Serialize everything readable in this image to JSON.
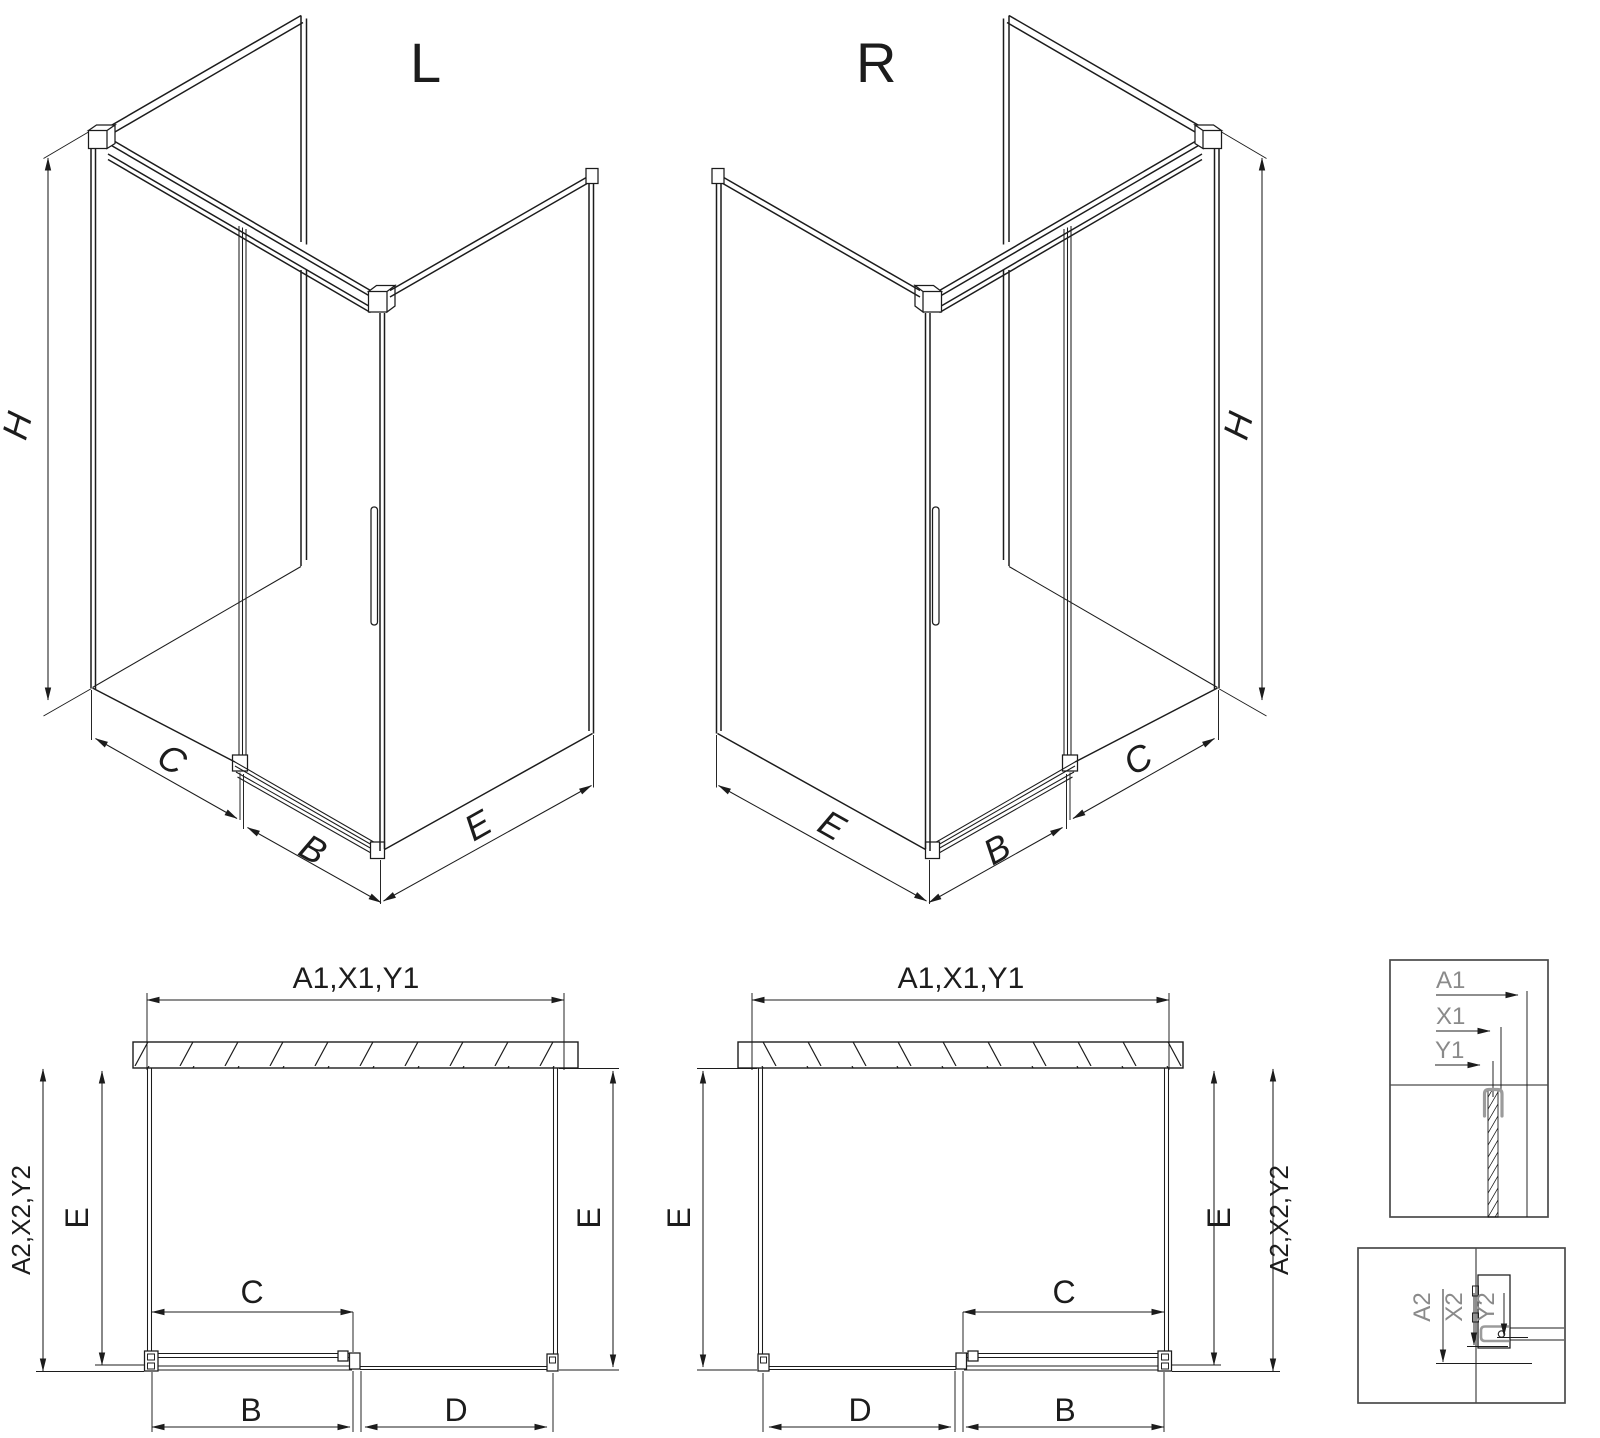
{
  "page": {
    "background": "#ffffff",
    "line_color": "#1c1c1c",
    "detail_label_color": "#8a8a8a"
  },
  "iso_views": {
    "left": {
      "label": "L",
      "height_dim": "H",
      "fixed_panel_dim": "C",
      "door_dim": "B",
      "side_panel_dim": "E"
    },
    "right": {
      "label": "R",
      "height_dim": "H",
      "fixed_panel_dim": "C",
      "door_dim": "B",
      "side_panel_dim": "E"
    }
  },
  "plan_views": {
    "left": {
      "width_dims": "A1,X1,Y1",
      "depth_dims": "A2,X2,Y2",
      "side_left": "E",
      "side_right": "E",
      "fixed_panel": "C",
      "door": "B",
      "opening": "D"
    },
    "right": {
      "width_dims": "A1,X1,Y1",
      "depth_dims": "A2,X2,Y2",
      "side_left": "E",
      "side_right": "E",
      "fixed_panel": "C",
      "door": "B",
      "opening": "D"
    }
  },
  "details": {
    "wall_profile_top": {
      "dims": [
        "A1",
        "X1",
        "Y1"
      ]
    },
    "bottom_rail": {
      "dims": [
        "A2",
        "X2",
        "Y2"
      ]
    }
  }
}
